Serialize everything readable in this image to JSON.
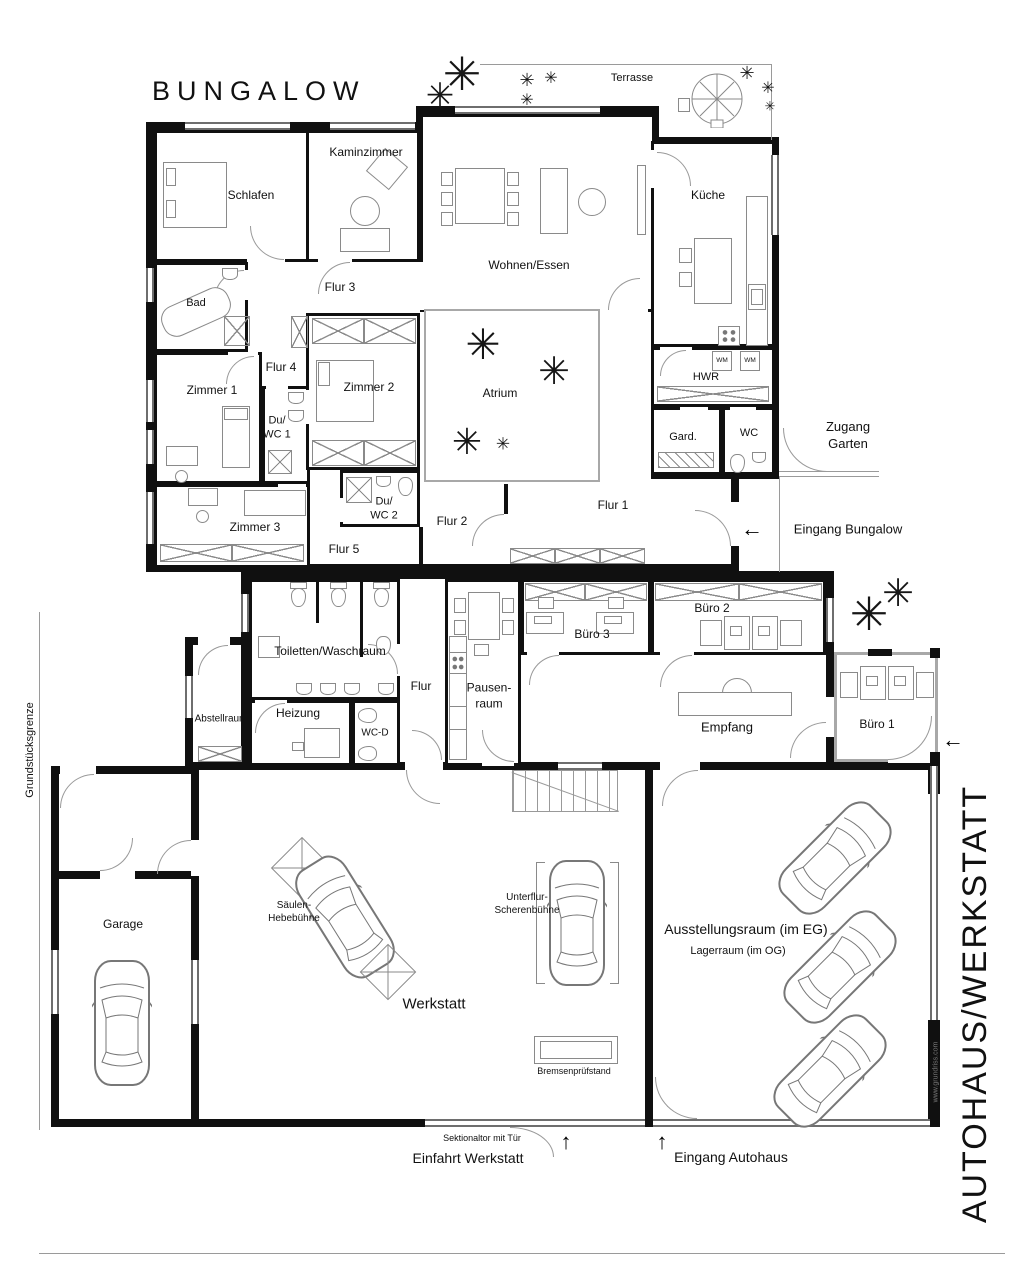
{
  "title": "BUNGALOW",
  "colors": {
    "wall": "#101010",
    "furniture_stroke": "#8a8a8a",
    "glass": "#a8a8a8",
    "boundary": "#9a9a9a"
  },
  "site": {
    "boundary_label": "Grundstücksgrenze",
    "section_label": "AUTOHAUS/WERKSTATT",
    "watermark": "www.grundriss.com"
  },
  "exterior": {
    "terrasse": "Terrasse",
    "zugang_garten": "Zugang\nGarten",
    "eingang_bungalow": "Eingang Bungalow",
    "einfahrt_werkstatt": "Einfahrt Werkstatt",
    "eingang_autohaus": "Eingang Autohaus",
    "sektionaltor": "Sektionaltor mit Tür",
    "arrow_left": "←",
    "arrow_up": "↑"
  },
  "bungalow": {
    "schlafen": "Schlafen",
    "kaminzimmer": "Kaminzimmer",
    "wohnen_essen": "Wohnen/Essen",
    "kueche": "Küche",
    "bad": "Bad",
    "flur1": "Flur 1",
    "flur2": "Flur 2",
    "flur3": "Flur 3",
    "flur4": "Flur 4",
    "flur5": "Flur 5",
    "zimmer1": "Zimmer 1",
    "zimmer2": "Zimmer 2",
    "zimmer3": "Zimmer 3",
    "du_wc1": "Du/\nWC 1",
    "du_wc2": "Du/\nWC 2",
    "atrium": "Atrium",
    "hwr": "HWR",
    "wm": "WM",
    "gard": "Gard.",
    "wc": "WC"
  },
  "buerotrakt": {
    "toiletten": "Toiletten/Waschraum",
    "abstellraum": "Abstellraum",
    "heizung": "Heizung",
    "wc_d": "WC-D",
    "flur": "Flur",
    "pausenraum": "Pausen-\nraum",
    "buero1": "Büro 1",
    "buero2": "Büro 2",
    "buero3": "Büro 3",
    "empfang": "Empfang"
  },
  "autohaus": {
    "garage": "Garage",
    "werkstatt": "Werkstatt",
    "saeulen_hebebuehne": "Säulen-\nHebebühne",
    "unterflur_scherenbuehne": "Unterflur-\nScherenbühne",
    "bremsenpruefstand": "Bremsenprüfstand",
    "ausstellungsraum": "Ausstellungsraum (im EG)",
    "lagerraum": "Lagerraum (im OG)"
  }
}
